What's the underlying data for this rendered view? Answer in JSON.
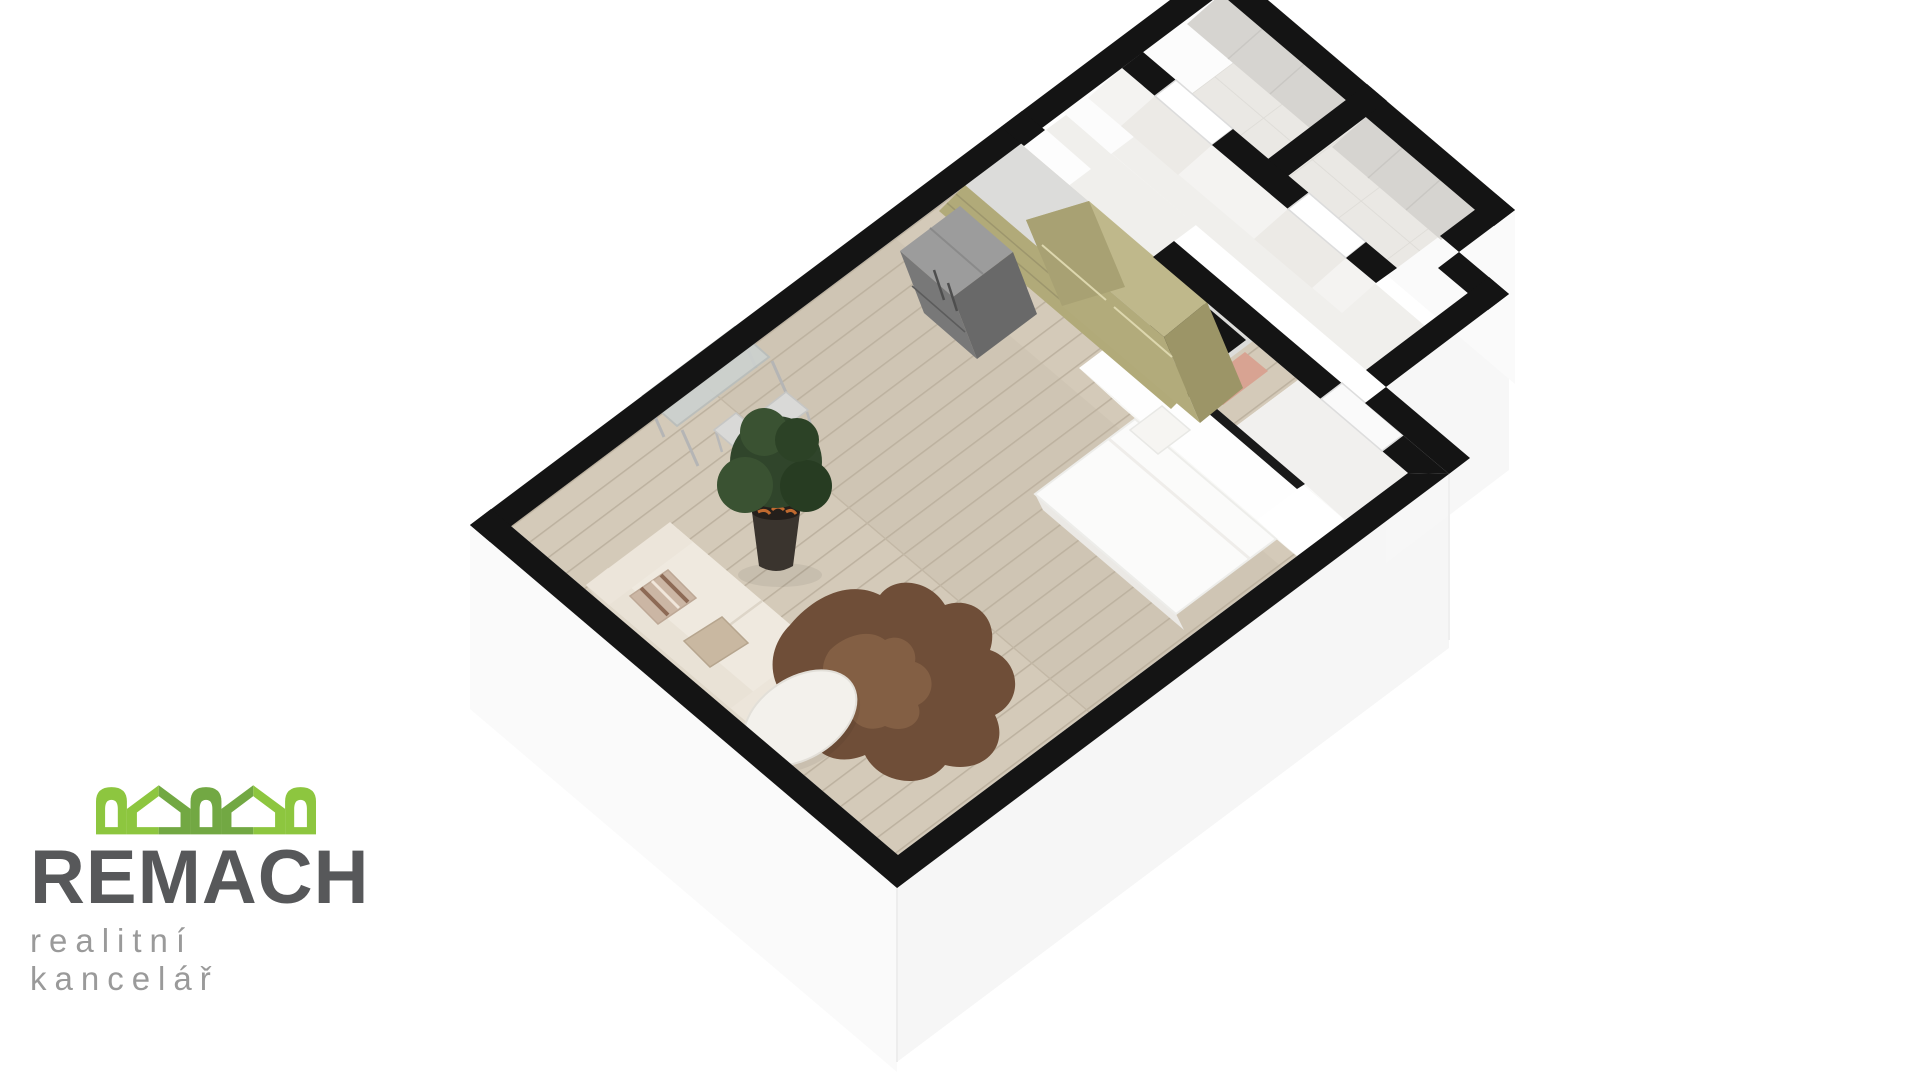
{
  "logo": {
    "title": "REMACH",
    "subtitle": "realitní kancelář",
    "colors": {
      "green_light": "#8dc63f",
      "green_dark": "#72a843",
      "title_gray": "#57585a",
      "subtitle_gray": "#9a9a9a"
    }
  },
  "floor_plan": {
    "type": "3d-axonometric-floor-plan",
    "rooms": [
      {
        "name": "living-room-with-kitchen",
        "floor": "wood"
      },
      {
        "name": "sleeping-nook",
        "floor": "wood"
      },
      {
        "name": "entry-hall",
        "floor": "white"
      },
      {
        "name": "corridor",
        "floor": "white"
      },
      {
        "name": "bathroom",
        "floor": "gray-tile"
      },
      {
        "name": "wc",
        "floor": "gray-tile"
      }
    ],
    "furniture": [
      "kitchen-upper-cabinets",
      "kitchen-base-cabinets",
      "kitchen-sink",
      "cooktop",
      "fridge",
      "console-table",
      "bar-stool",
      "bar-stool",
      "potted-plant",
      "wall-picture",
      "sofa",
      "striped-pillow",
      "beige-pillow",
      "coffee-table",
      "animal-hide-rug",
      "double-bed"
    ],
    "colors": {
      "wall_cap": "#141414",
      "wall_face": "#fbfbfb",
      "wood_floor": "#cfc5b4",
      "plank_line": "#bdb2a0",
      "kitchen_olive": "#b2ab7b",
      "kitchen_olive_dark": "#9c9567",
      "counter_gray": "#dcdcda",
      "tile_floor": "#eae8e4",
      "gray_wall_tile": "#d6d4d0",
      "sofa_cream": "#efe9df",
      "rug_brown": "#6f4e38",
      "accent_salmon": "#d8a392"
    }
  }
}
